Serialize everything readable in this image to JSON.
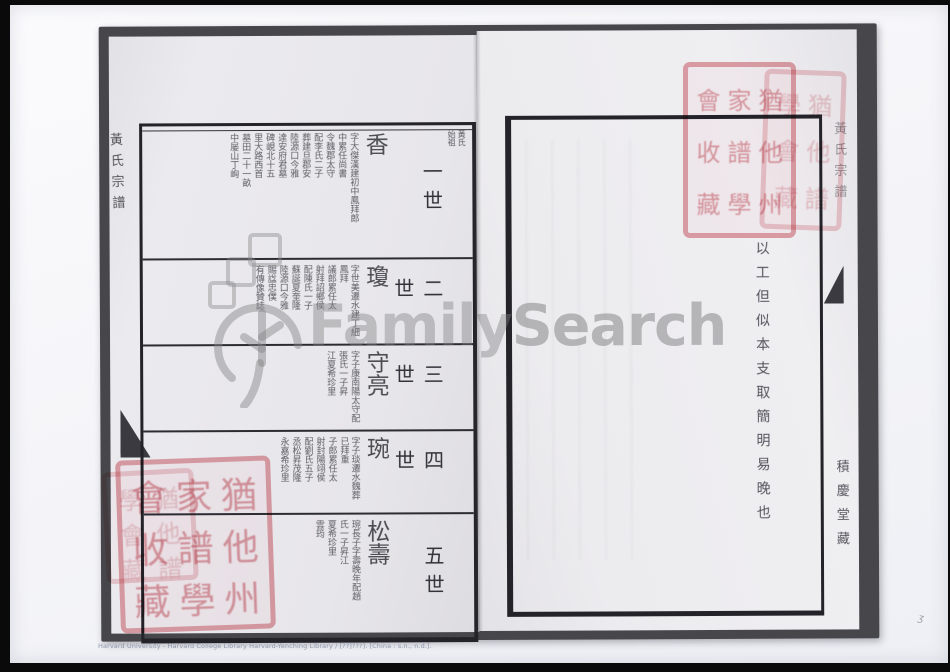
{
  "caption": "Harvard University - Harvard College Library Harvard-Yenching Library / [??]???]. [China : s.n., n.d.].",
  "watermark": {
    "brand_family": "Family",
    "brand_search": "Search",
    "tree_icon": "familysearch-tree-icon",
    "color": "#7e7e80"
  },
  "book": {
    "left_page": {
      "spine_title": "黃氏宗譜",
      "rows": [
        {
          "generation": "一世",
          "header": [
            "黃氏",
            "始祖"
          ],
          "name": "香",
          "name_note": "字大傑漢建初中鳳拜郎",
          "notes": [
            "中累任尚書",
            "令魏郡太守",
            "配李氏二子",
            "葬建旦郡安",
            "陸源口今雅",
            "達安府君墓",
            "碑峴北十五",
            "里大路西首",
            "墓田二十一畝",
            "中屡山丁峋"
          ]
        },
        {
          "generation": "二世",
          "header": [],
          "name": "瓊",
          "name_note": "字世美遷水建丁細鳳拜",
          "notes": [
            "議郎累任太",
            "射拜詔鄉侯",
            "配陳氏一子",
            "蘇誕夏奎隆",
            "陸源口今雅",
            "賜諡忠僕",
            "有傳像贊誌"
          ]
        },
        {
          "generation": "三世",
          "header": [],
          "name": "守亮",
          "name_note": "字子康南陽太守配",
          "notes": [
            "張氏一子昇",
            "江夏希珍里"
          ]
        },
        {
          "generation": "四世",
          "header": [],
          "name": "琬",
          "name_note": "字子琰遷水魏葬已拜重",
          "notes": [
            "子郎累任太",
            "射封陽翊侯",
            "配劉氏五子",
            "丞松昇茂隆",
            "永嘉希珍里"
          ]
        },
        {
          "generation": "五世",
          "header": [],
          "name": "松壽",
          "name_note": "琬長子字壽晚年配趙",
          "notes": [
            "氏一子昇江",
            "夏希珍里",
            "雲筠"
          ]
        }
      ]
    },
    "right_page": {
      "annotation": "以工但似本支取簡明易晚也",
      "spine_title": "黃氏宗譜",
      "hall_mark": "積慶堂藏"
    },
    "seals": {
      "color": "#d8707a",
      "large_chars": [
        "猶",
        "他",
        "州",
        "家",
        "譜",
        "學",
        "會",
        "收",
        "藏"
      ],
      "small_chars": [
        "猶",
        "他",
        "譜",
        "學",
        "會",
        "藏"
      ]
    }
  }
}
